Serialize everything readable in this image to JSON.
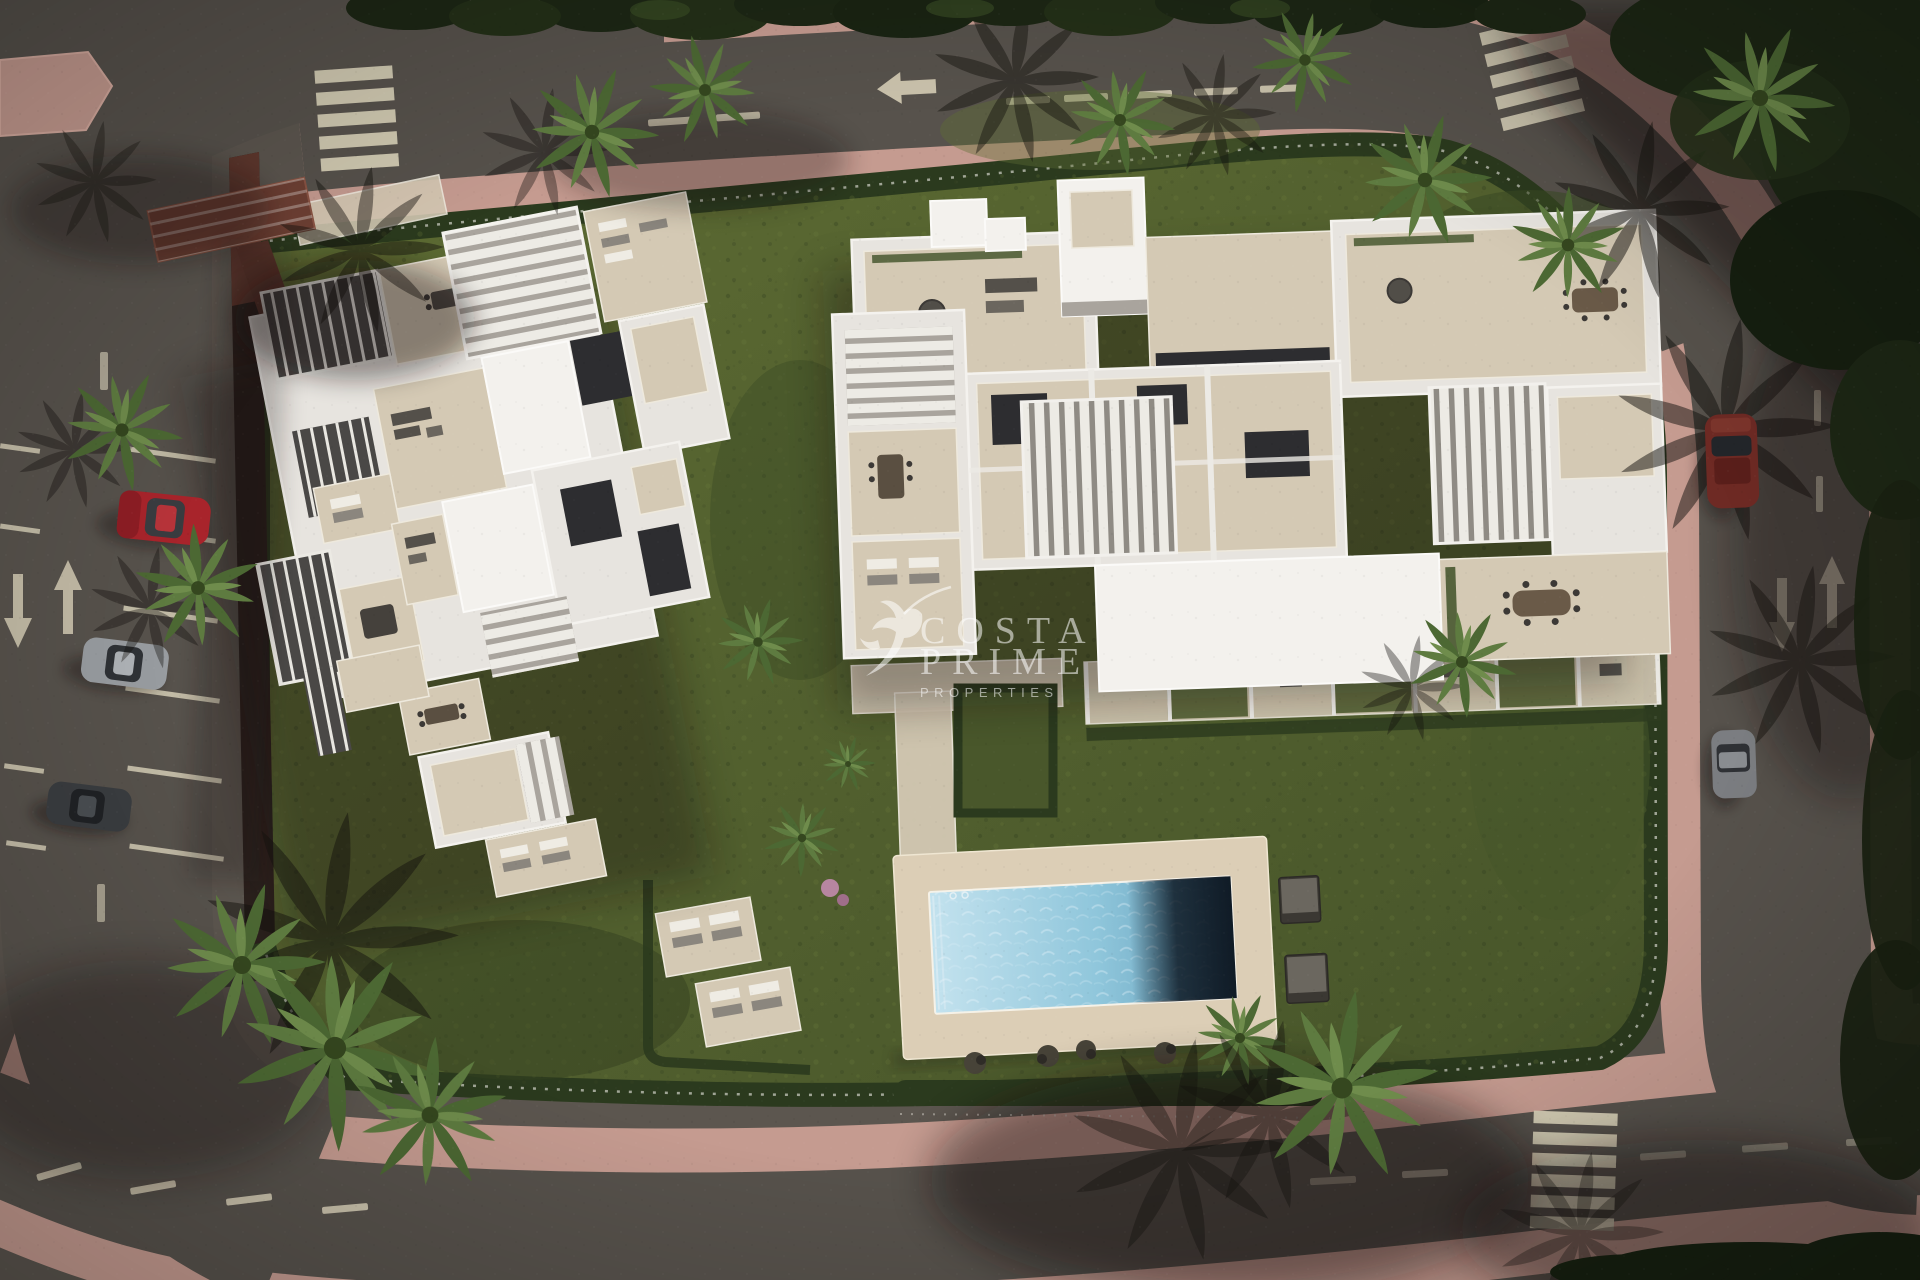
{
  "watermark": {
    "logo_icon": "hummingbird-icon",
    "brand_line1": "COSTA",
    "brand_line2": "PRIME",
    "brand_line3": "PROPERTIES"
  },
  "colors": {
    "asphalt": "#57524c",
    "sidewalk": "#c59b90",
    "grass": "#55632f",
    "hedge": "#2b3a1e",
    "building_white": "#e7e4df",
    "building_bright": "#f3f1ed",
    "terrace_beige": "#d4c9b4",
    "pool_water": "#8fc6db",
    "pool_deep": "#101b26",
    "road_marking": "#ded6bd",
    "car_red": "#a8242b",
    "car_silver": "#989ca0",
    "car_dark": "#3a3d40",
    "car_maroon": "#6e2a24",
    "watermark_white": "rgba(255,255,255,0.55)"
  },
  "objects": [
    "apartment-building-west",
    "apartment-building-east",
    "swimming-pool",
    "pool-sun-deck",
    "garden-hedges",
    "palm-trees",
    "ring-road",
    "pink-sidewalks",
    "zebra-crossing-top-left",
    "zebra-crossing-top-right",
    "zebra-crossing-bottom-right",
    "parked-car-red",
    "parked-car-silver",
    "parked-car-dark",
    "parked-car-maroon",
    "parked-car-gray"
  ]
}
